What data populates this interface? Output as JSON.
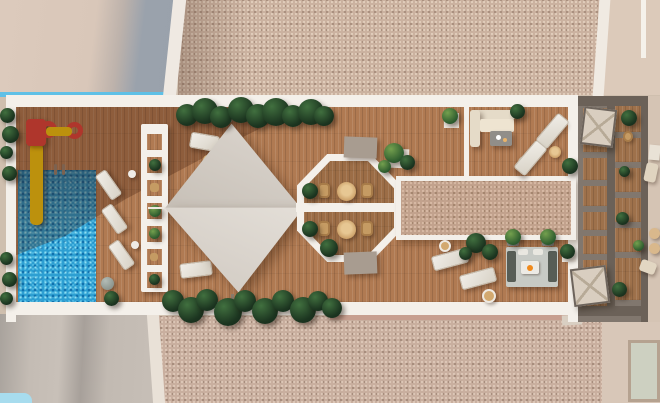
{
  "type": "3d-architectural-render",
  "view": "top-down aerial plan view",
  "scene": "rooftop communal sun terrace of a residential building flanked by adjacent roofs",
  "palette": {
    "pool_blue": "#2d9fd2",
    "pool_highlight": "#8fdef2",
    "deck_wood": "#b07a52",
    "gravel_roof": "#cbb2a0",
    "concrete_beige": "#d9c8bb",
    "shadow_gray": "#9aa2ac",
    "white_trim": "#f4f0ea",
    "hedge_green": "#1c3520",
    "plant_bright_green": "#2c5a2e",
    "sail_gray": "#d8d2ca",
    "slide_yellow": "#f3c40f",
    "slide_red": "#e0433b",
    "parasol_beige": "#d9cec0",
    "partition_taupe": "#6b6158",
    "wicker_tan": "#c59b63",
    "fire_flame_orange": "#f08a1c",
    "sky_blue_reflection": "#5fc0e6"
  },
  "zones": [
    {
      "name": "adjacent-roof-top-left",
      "surface": "plain concrete with cast shadow and blue glass edge"
    },
    {
      "name": "adjacent-roof-top-right",
      "surface": "speckled gravel"
    },
    {
      "name": "pool-zone",
      "items": [
        "blue mosaic swimming pool",
        "pool ladder",
        "yellow water slide with red tower",
        "red play wheels with yellow bar",
        "3 white sun loungers",
        "white slatted pergola walkway",
        "side hedge plants"
      ]
    },
    {
      "name": "shade-sail-lounge",
      "items": [
        "2 triangular shade sails",
        "round cocktail table",
        "2 sun loungers",
        "boxwood hedge rows top and bottom"
      ]
    },
    {
      "name": "octagonal-dining-pavilion",
      "items": [
        "4 wicker chairs",
        "2 round tables",
        "3 shrubs",
        "white crossing walkway",
        "2 concrete planter blocks"
      ]
    },
    {
      "name": "central-pergola",
      "surface": "gravel-topped canopy with white frame"
    },
    {
      "name": "north-lounge",
      "items": [
        "L-shaped beige sofa",
        "gray coffee table",
        "2 diagonal sun loungers",
        "round side table",
        "pouf",
        "potted plants",
        "white divider wall"
      ]
    },
    {
      "name": "fire-pit-lounge",
      "items": [
        "fire table with flame",
        "2 dark bench sofas",
        "2 potted trees",
        "2 sun loungers",
        "2 round poufs",
        "dark shrubs"
      ]
    },
    {
      "name": "private-terraces-east",
      "items": [
        "2 square beige parasols",
        "timber deck cells",
        "taupe partition walls",
        "potted plants",
        "wicker chair"
      ]
    },
    {
      "name": "east-neighbor-strip",
      "items": [
        "beige chairs",
        "2 round tan tables",
        "white storage box"
      ]
    },
    {
      "name": "adjacent-ground-bottom",
      "surface": "concrete with shadows, gravel field, pale paver court"
    }
  ],
  "counts": {
    "shade_sails": 2,
    "sun_loungers_total": 9,
    "parasols": 2,
    "octagon_tables": 2,
    "octagon_chairs": 4
  }
}
